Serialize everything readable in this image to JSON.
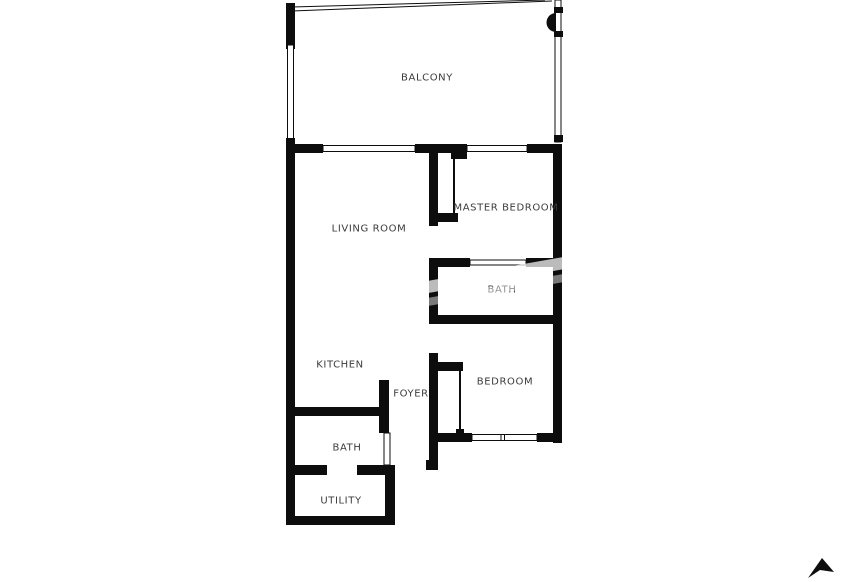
{
  "page": {
    "kind": "floor-plan"
  },
  "colors": {
    "background": "#ffffff",
    "wall": "#0d0d0d",
    "label": "#3b3b3b"
  },
  "rooms": [
    {
      "id": "balcony",
      "label": "BALCONY",
      "x": 427,
      "y": 78
    },
    {
      "id": "living-room",
      "label": "LIVING ROOM",
      "x": 369,
      "y": 229
    },
    {
      "id": "master-bedroom",
      "label": "MASTER BEDROOM",
      "x": 506,
      "y": 208
    },
    {
      "id": "master-bath",
      "label": "BATH",
      "x": 502,
      "y": 290
    },
    {
      "id": "kitchen",
      "label": "KITCHEN",
      "x": 340,
      "y": 365
    },
    {
      "id": "foyer",
      "label": "FOYER",
      "x": 411,
      "y": 394
    },
    {
      "id": "bedroom",
      "label": "BEDROOM",
      "x": 505,
      "y": 382
    },
    {
      "id": "bath",
      "label": "BATH",
      "x": 347,
      "y": 448
    },
    {
      "id": "utility",
      "label": "UTILITY",
      "x": 341,
      "y": 501
    }
  ],
  "compass": {
    "icon": "north-arrow"
  }
}
